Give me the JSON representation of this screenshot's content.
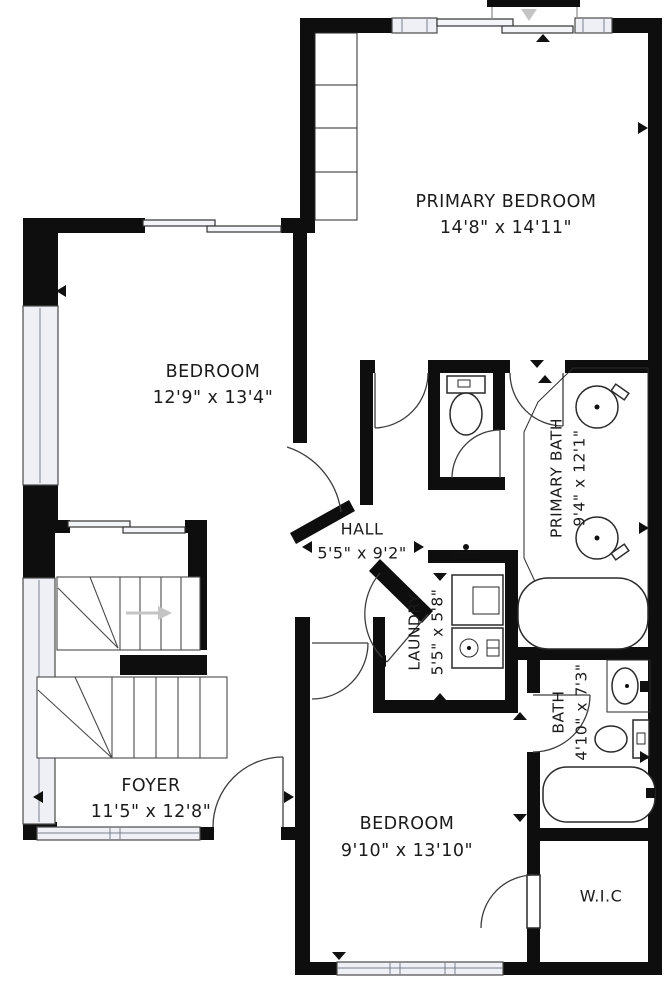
{
  "plan": {
    "type": "residential-floor-plan",
    "colors": {
      "wall": "#0e0e0e",
      "window_fill": "#eef0f5",
      "fixture_stroke": "#2a2a2a",
      "text": "#1b1b1b",
      "direction_arrow_gray": "#c4c4c4",
      "background": "#ffffff"
    },
    "rooms": [
      {
        "name": "PRIMARY BEDROOM",
        "dimensions": "14'8\" x 14'11\""
      },
      {
        "name": "BEDROOM",
        "dimensions": "12'9\" x 13'4\""
      },
      {
        "name": "HALL",
        "dimensions": "5'5\" x 9'2\""
      },
      {
        "name": "PRIMARY BATH",
        "dimensions": "9'4\" x 12'1\""
      },
      {
        "name": "LAUNDRY",
        "dimensions": "5'5\" x 5'8\""
      },
      {
        "name": "BATH",
        "dimensions": "4'10\" x 7'3\""
      },
      {
        "name": "FOYER",
        "dimensions": "11'5\" x 12'8\""
      },
      {
        "name": "BEDROOM",
        "dimensions": "9'10\" x 13'10\""
      },
      {
        "name": "W.I.C",
        "dimensions": ""
      }
    ],
    "fixtures": [
      "toilet",
      "round-sink",
      "oval-sink",
      "bathtub",
      "washer",
      "utility-sink",
      "closet-shelves",
      "stairs",
      "sliding-door",
      "entry-arrow"
    ]
  }
}
